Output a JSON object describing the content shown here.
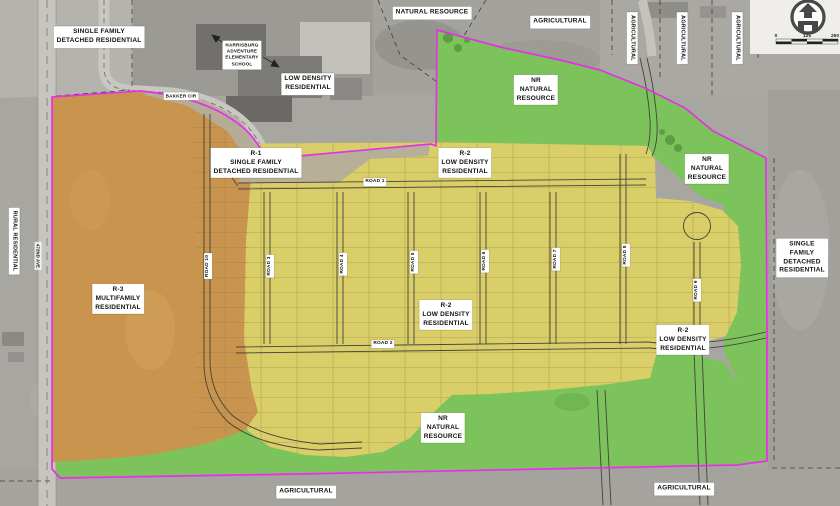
{
  "map": {
    "colors": {
      "photo_gray": "#a8a6a1",
      "boundary_magenta": "#e431e4",
      "r3_multifamily_orange": "#c9944e",
      "r2_low_density_yellow": "#d9ce67",
      "natural_resource_green": "#7dc35c",
      "r1_band_tan": "#b4ad9b",
      "road_line": "#44423d",
      "label_bg": "#ffffff",
      "label_text": "#111111"
    },
    "icons": {
      "logo": "house-arrow-icon"
    },
    "scale_bar": {
      "ticks": [
        "0",
        "125",
        "250"
      ]
    },
    "labels": [
      {
        "name": "label-single-family-top-left",
        "text": "SINGLE FAMILY\nDETACHED RESIDENTIAL",
        "x": 99,
        "y": 37
      },
      {
        "name": "label-natural-resource-top",
        "text": "NATURAL RESOURCE",
        "x": 432,
        "y": 13
      },
      {
        "name": "label-agricultural-top",
        "text": "AGRICULTURAL",
        "x": 560,
        "y": 22
      },
      {
        "name": "label-agricultural-vertical-1",
        "text": "AGRICULTURAL",
        "x": 632,
        "y": 38,
        "rot": 90,
        "size": 5.5
      },
      {
        "name": "label-agricultural-vertical-2",
        "text": "AGRICULTURAL",
        "x": 682,
        "y": 38,
        "rot": 90,
        "size": 5.5
      },
      {
        "name": "label-agricultural-vertical-3",
        "text": "AGRICULTURAL",
        "x": 737,
        "y": 38,
        "rot": 90,
        "size": 5.5
      },
      {
        "name": "label-school",
        "text": "HARRISBURG\nADVENTURE\nELEMENTARY\nSCHOOL",
        "x": 242,
        "y": 55,
        "size": 4.6
      },
      {
        "name": "label-low-density-residential-top",
        "text": "LOW DENSITY\nRESIDENTIAL",
        "x": 308,
        "y": 84
      },
      {
        "name": "label-bakker-cir",
        "text": "BAKKER CIR",
        "x": 181,
        "y": 96,
        "size": 4.6,
        "cls": "road"
      },
      {
        "name": "label-nr-natural-resource-top",
        "text": "NR\nNATURAL\nRESOURCE",
        "x": 536,
        "y": 90
      },
      {
        "name": "label-r1-single-family",
        "text": "R-1\nSINGLE FAMILY\nDETACHED RESIDENTIAL",
        "x": 256,
        "y": 163
      },
      {
        "name": "label-r2-low-density-top",
        "text": "R-2\nLOW DENSITY\nRESIDENTIAL",
        "x": 465,
        "y": 163
      },
      {
        "name": "label-nr-natural-resource-right",
        "text": "NR\nNATURAL\nRESOURCE",
        "x": 707,
        "y": 169
      },
      {
        "name": "label-single-family-right",
        "text": "SINGLE FAMILY\nDETACHED\nRESIDENTIAL",
        "x": 802,
        "y": 258
      },
      {
        "name": "label-rural-residential",
        "text": "RURAL RESIDENTIAL",
        "x": 14,
        "y": 241,
        "rot": 90,
        "size": 5.5
      },
      {
        "name": "label-r3-multifamily",
        "text": "R-3\nMULTIFAMILY\nRESIDENTIAL",
        "x": 118,
        "y": 299
      },
      {
        "name": "label-r2-low-density-center",
        "text": "R-2\nLOW DENSITY\nRESIDENTIAL",
        "x": 446,
        "y": 315
      },
      {
        "name": "label-r2-low-density-right",
        "text": "R-2\nLOW DENSITY\nRESIDENTIAL",
        "x": 683,
        "y": 340
      },
      {
        "name": "label-nr-natural-resource-bottom",
        "text": "NR\nNATURAL\nRESOURCE",
        "x": 443,
        "y": 428
      },
      {
        "name": "label-agricultural-bottom-center",
        "text": "AGRICULTURAL",
        "x": 306,
        "y": 492
      },
      {
        "name": "label-agricultural-bottom-right",
        "text": "AGRICULTURAL",
        "x": 684,
        "y": 489
      },
      {
        "name": "label-road-1",
        "text": "ROAD 1",
        "x": 375,
        "y": 182,
        "cls": "road"
      },
      {
        "name": "label-road-2",
        "text": "ROAD 2",
        "x": 383,
        "y": 344,
        "cls": "road"
      },
      {
        "name": "label-road-10",
        "text": "ROAD 10",
        "x": 208,
        "y": 266,
        "rot": -90,
        "cls": "road"
      },
      {
        "name": "label-road-3",
        "text": "ROAD 3",
        "x": 270,
        "y": 266,
        "rot": -90,
        "cls": "road"
      },
      {
        "name": "label-road-4",
        "text": "ROAD 4",
        "x": 343,
        "y": 264,
        "rot": -90,
        "cls": "road"
      },
      {
        "name": "label-road-5",
        "text": "ROAD 5",
        "x": 414,
        "y": 262,
        "rot": -90,
        "cls": "road"
      },
      {
        "name": "label-road-6",
        "text": "ROAD 6",
        "x": 485,
        "y": 261,
        "rot": -90,
        "cls": "road"
      },
      {
        "name": "label-road-7",
        "text": "ROAD 7",
        "x": 556,
        "y": 259,
        "rot": -90,
        "cls": "road"
      },
      {
        "name": "label-road-8",
        "text": "ROAD 8",
        "x": 626,
        "y": 255,
        "rot": -90,
        "cls": "road"
      },
      {
        "name": "label-road-9",
        "text": "ROAD 9",
        "x": 697,
        "y": 290,
        "rot": -90,
        "cls": "road"
      },
      {
        "name": "label-472nd-ave",
        "text": "472ND AVE",
        "x": 38,
        "y": 256,
        "rot": 90,
        "size": 4.2,
        "cls": "road plain"
      }
    ]
  }
}
